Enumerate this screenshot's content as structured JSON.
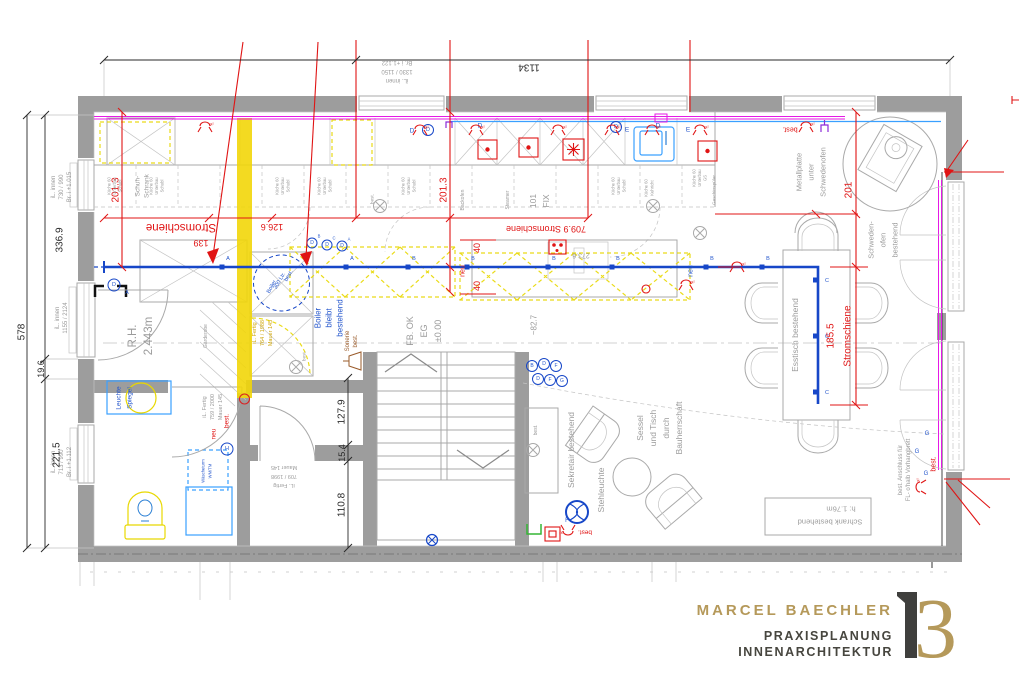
{
  "dims": {
    "total_w": "1134",
    "total_h": "578",
    "h1": "336.9",
    "h2": "19.6",
    "h3": "221.5",
    "col_left": "201.3",
    "col_mid": "201.3",
    "col_right": "201",
    "table": "185.5",
    "strom_word": "Stromschiene",
    "strom_left_len": "139",
    "strom_mid": "126.6",
    "strom_right": "709.9 Stromschiene",
    "n40": "40",
    "stair1": "127.9",
    "wall": "15.4",
    "stair2": "110.8",
    "n82": "~82.7",
    "n273": "273.6"
  },
  "win": {
    "left_top": [
      "iL. innen",
      "730 / 990",
      "Br. i +1.015"
    ],
    "left_mid": [
      "iL. innen",
      "1155 / 2124"
    ],
    "left_bot": [
      "iL. innen",
      "713 / 990",
      "Br. i +1.112"
    ],
    "top": [
      "iL. innen",
      "1330 / 1150",
      "Br. i +1.122"
    ]
  },
  "doors": {
    "d764": [
      "iL. Fertig",
      "764 / 1988",
      "Mauer 145"
    ],
    "d759": [
      "iL. Fertig",
      "759 / 2000",
      "Mauer 145"
    ],
    "d709": [
      "iL. Fertig",
      "709 / 1998",
      "Mauer 145"
    ]
  },
  "rooms": {
    "rh": [
      "R.H.",
      "2.443m"
    ],
    "floor": [
      "FB. OK",
      "EG",
      "±0.00"
    ],
    "garderobe": "Garderobe"
  },
  "kitchen": {
    "unit": [
      "Küche 60",
      "Unterbau",
      "Schubl"
    ],
    "kehricht": [
      "Küche 60",
      "Kehricht"
    ],
    "gs": [
      "Küche 60",
      "Unterbau",
      "GS"
    ],
    "geschirr": "Geschirrspüler",
    "backofen": "Backofen",
    "steamer": "Steamer",
    "fix": [
      "101",
      "FIX"
    ],
    "schuh": [
      "Schuh-",
      "Schrank"
    ]
  },
  "furniture": {
    "esstisch": "Esstisch bestehend",
    "schrank": [
      "Schrank bestehend",
      "h: 1.76m"
    ],
    "sekretair": "Sekretair bestehend",
    "stehleuchte": "Stehleuchte",
    "sessel": [
      "Sessel",
      "und Tisch",
      "durch",
      "Bauherrschaft"
    ],
    "ofen": [
      "Schweden-",
      "ofen",
      "bestehend"
    ],
    "metall": [
      "Metallplatte",
      "unter",
      "Schwedenofen"
    ],
    "boiler_tag": [
      "Boiler",
      "300 Ltr.",
      "best."
    ],
    "boiler_note": [
      "Boiler",
      "bleibt",
      "bestehend"
    ],
    "wasch": [
      "Wäscheturm",
      "WM/TM"
    ],
    "spiegel": [
      "Leuchte",
      "Spiegel"
    ]
  },
  "elec": {
    "neu": "neu",
    "best": "best.",
    "x2": "x²",
    "sonerie": [
      "Sonerie",
      "best."
    ],
    "anschluss": [
      "best. Anschluss für",
      "FL- o'halb Vorhangbrett"
    ],
    "letters": {
      "a": "A",
      "b": "B",
      "c": "C",
      "d": "D",
      "e": "E",
      "f": "F",
      "g": "G",
      "h": "H"
    }
  },
  "logo": {
    "name": "MARCEL BAECHLER",
    "sub1": "PRAXISPLANUNG",
    "sub2": "INNENARCHITEKTUR",
    "mark": "3"
  },
  "colors": {
    "wall": "#9d9d9d",
    "red": "#e01414",
    "blue": "#1747c8",
    "magenta": "#e619e6",
    "cyan": "#3aa0ff",
    "yellow": "#f2d60a",
    "gold": "#b5995a",
    "dark": "#47463f"
  }
}
